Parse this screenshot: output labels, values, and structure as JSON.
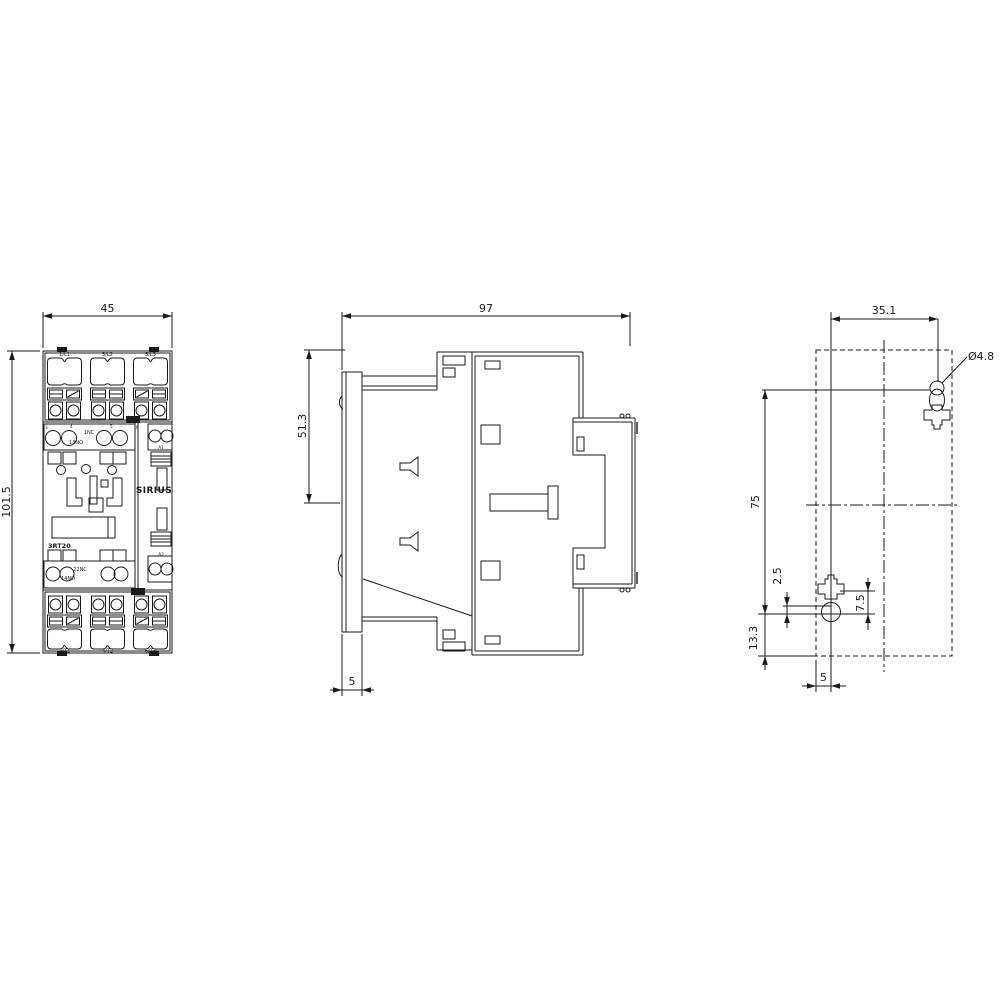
{
  "front_view": {
    "dim_width": "45",
    "dim_height": "101.5",
    "terminals_top": [
      "1/L1",
      "3/L2",
      "5/L3"
    ],
    "terminals_bottom": [
      "2/T1",
      "4/T2",
      "6/T3"
    ],
    "aux_contact_marks": [
      "3",
      "4",
      "5",
      "6"
    ],
    "aux_top_no": "13NO",
    "aux_top_nc": "1NC",
    "aux_bottom_nc": "22NC",
    "aux_bottom_no": "14NO",
    "coil_terminal_top": "A1",
    "coil_terminal_bottom": "A2",
    "brand": "SIRIUS",
    "model": "3RT20"
  },
  "side_view": {
    "dim_depth": "97",
    "dim_top_section": "51.3",
    "dim_rail_depth": "5"
  },
  "drilling_plan": {
    "dim_hole_spacing_x": "35.1",
    "dim_hole_diameter": "Ø4.8",
    "dim_hole_spacing_y": "75",
    "dim_slot_offset": "2.5",
    "dim_slot_to_hole": "7.5",
    "dim_bottom_offset": "13.3",
    "dim_edge_offset": "5"
  }
}
